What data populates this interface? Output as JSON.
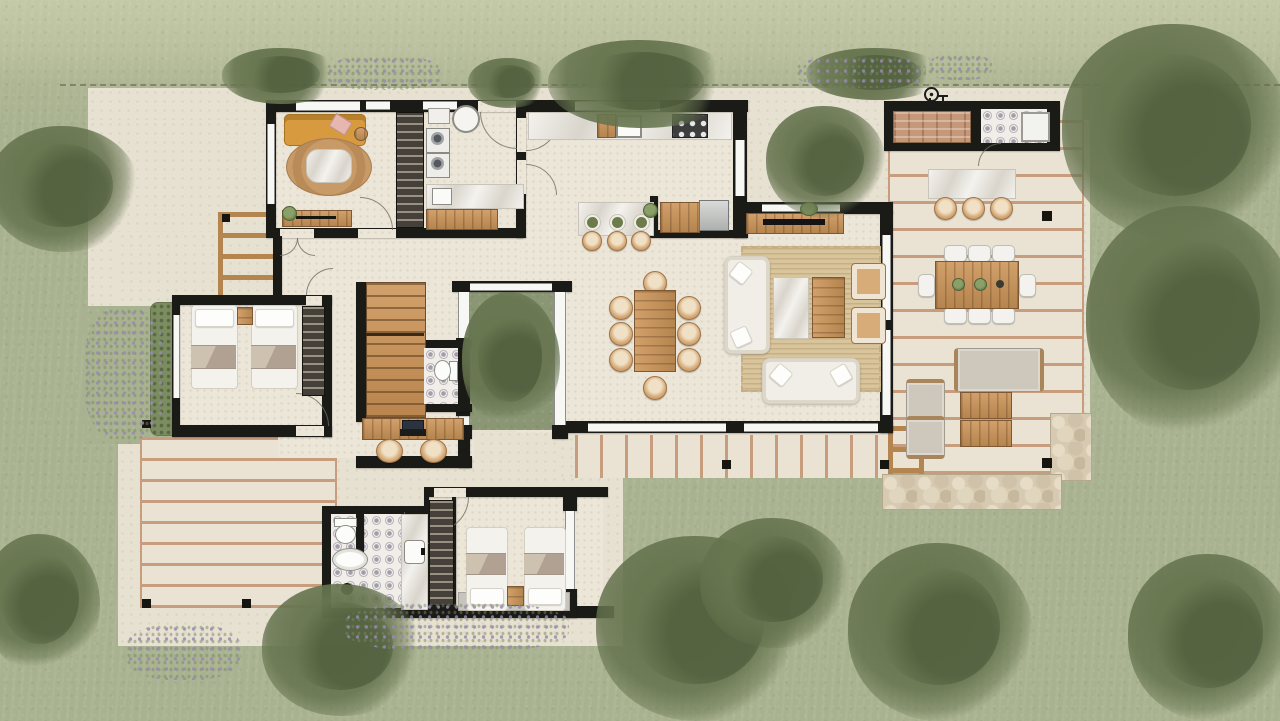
{
  "meta": {
    "type": "architectural-floor-plan-site-render",
    "canvas_width": 1280,
    "canvas_height": 721,
    "text_content": "none (purely graphical plan)"
  },
  "palette": {
    "grass": "#a9b290",
    "grass_light": "#c3c8a6",
    "concrete": "#e7e1d1",
    "deck": "#eae3d3",
    "plank": "#c79d7e",
    "wall": "#1a1a17",
    "floor": "#ece6d8",
    "marble_a": "#f4f2ee",
    "marble_b": "#d9d5cc",
    "wood": "#b5854f",
    "wood_light": "#d2a06a",
    "rattan": "#d8ac79",
    "glass": "#f7f7f4",
    "frame": "#8e8e8e",
    "tile_base": "#f1eeea",
    "tile_dot": "#a39daa",
    "court_green": "#8b9774",
    "stone": "#d6cab2",
    "mustard": "#d79a3f",
    "pink": "#e6b7ae",
    "throw_taupe": "#b1a192",
    "lavender": "#978ab0",
    "tree_green": "#67774f"
  },
  "site": {
    "ground": "lawn",
    "property_line_style": "dashed",
    "tree_clusters": 14,
    "lavender_patches": 6,
    "deck_lights": 8,
    "features": [
      "west-trellis-pergola",
      "entry-walkway",
      "south-boardwalk",
      "stone-patio",
      "inner-courtyard-tree"
    ]
  },
  "house": {
    "rooms": [
      {
        "id": "den",
        "furniture": [
          "mustard-sofa",
          "pink-pillow",
          "oval-jute-rug",
          "marble-coffee-table",
          "side-table",
          "media-console",
          "console-plant",
          "wardrobe-closet"
        ]
      },
      {
        "id": "laundry-utility",
        "furniture": [
          "round-basin",
          "counter-unit",
          "washer",
          "dryer",
          "utility-sink",
          "marble-pantry-counter",
          "wood-shelf"
        ]
      },
      {
        "id": "entry-hall",
        "furniture": [
          "door-swings"
        ]
      },
      {
        "id": "kitchen",
        "furniture": [
          "marble-counter",
          "kitchen-sink",
          "cutting-board",
          "cooktop-6-burner",
          "island-marble",
          "bar-stool",
          "bar-stool",
          "bar-stool",
          "plates-3",
          "island-plant",
          "wood-counter",
          "fridge"
        ]
      },
      {
        "id": "dining",
        "furniture": [
          "wood-dining-table",
          "rattan-chairs-8"
        ]
      },
      {
        "id": "living",
        "furniture": [
          "tv-console",
          "tv",
          "jute-area-rug",
          "white-sofa-vertical",
          "white-sofa-horizontal",
          "rattan-armchair",
          "rattan-armchair",
          "marble-coffee-table",
          "wood-coffee-table",
          "plant"
        ]
      },
      {
        "id": "courtyard",
        "furniture": [
          "courtyard-tree",
          "glass-walls"
        ]
      },
      {
        "id": "staircase",
        "furniture": [
          "wood-treads"
        ]
      },
      {
        "id": "powder-room",
        "furniture": [
          "toilet",
          "patterned-tile-floor"
        ]
      },
      {
        "id": "study-nook",
        "furniture": [
          "wood-desk",
          "laptop",
          "keyboard",
          "rattan-chair",
          "rattan-chair"
        ]
      },
      {
        "id": "bedroom-west",
        "furniture": [
          "twin-bed",
          "twin-bed",
          "nightstand",
          "closet",
          "window-west"
        ]
      },
      {
        "id": "bathroom",
        "furniture": [
          "toilet",
          "oval-tub",
          "shower-drain",
          "partition",
          "marble-vanity",
          "vanity-sink",
          "closet"
        ]
      },
      {
        "id": "bedroom-south",
        "furniture": [
          "twin-bed",
          "twin-bed",
          "nightstand",
          "gray-mat",
          "closet",
          "window-east"
        ]
      }
    ]
  },
  "outdoor": {
    "right_deck": [
      "grill-brick-counter",
      "outdoor-shower-tile-room",
      "shower-tray",
      "marble-bar-counter",
      "bar-stool",
      "bar-stool",
      "bar-stool",
      "outdoor-dining-table",
      "white-chairs-8",
      "table-plants-3",
      "outdoor-sofa",
      "outdoor-armchair",
      "outdoor-armchair",
      "wood-coffee-table",
      "wood-coffee-table",
      "stone-patio",
      "deck-steps"
    ],
    "west_deck": [
      "plank-decking",
      "corner-lights"
    ],
    "boardwalk": [
      "plank-decking",
      "lights"
    ],
    "fixtures": [
      "outdoor-shower-fixture-icon"
    ]
  }
}
